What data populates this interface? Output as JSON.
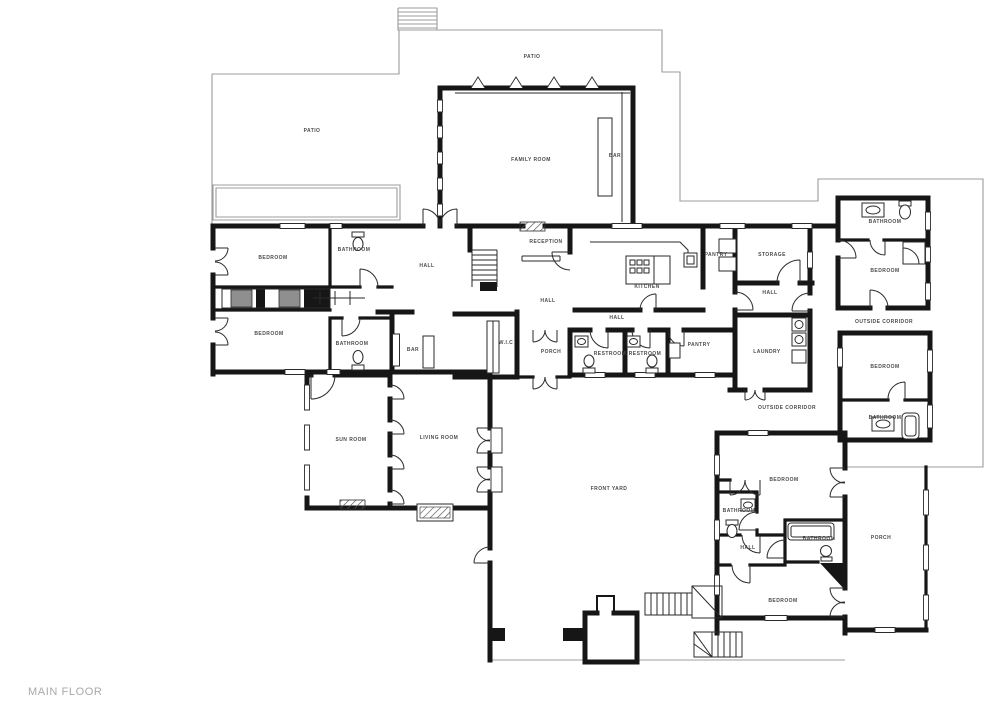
{
  "title": {
    "text": "MAIN FLOOR"
  },
  "colors": {
    "wall": "#161616",
    "thin_outline": "#9c9c9c",
    "label_text": "#4c4c4c",
    "title_text": "#a9a9a9",
    "closet_fill": "#8f8f8f",
    "background": "#ffffff"
  },
  "floor_labels": [
    {
      "id": "patio-top",
      "label": "PATIO"
    },
    {
      "id": "patio-left",
      "label": "PATIO"
    },
    {
      "id": "family-room",
      "label": "FAMILY ROOM"
    },
    {
      "id": "bar-family",
      "label": "BAR"
    },
    {
      "id": "bedroom-nw",
      "label": "BEDROOM"
    },
    {
      "id": "bathroom-nw",
      "label": "BATHROOM"
    },
    {
      "id": "hall-west",
      "label": "HALL"
    },
    {
      "id": "reception",
      "label": "RECEPTION"
    },
    {
      "id": "kitchen",
      "label": "KITCHEN"
    },
    {
      "id": "pantry-north",
      "label": "PANTRY"
    },
    {
      "id": "storage",
      "label": "STORAGE"
    },
    {
      "id": "hall-center",
      "label": "HALL"
    },
    {
      "id": "hall-east",
      "label": "HALL"
    },
    {
      "id": "bathroom-ne",
      "label": "BATHROOM"
    },
    {
      "id": "bedroom-ne",
      "label": "BEDROOM"
    },
    {
      "id": "outside-corridor-ne",
      "label": "OUTSIDE CORRIDOR"
    },
    {
      "id": "bedroom-w",
      "label": "BEDROOM"
    },
    {
      "id": "bathroom-w",
      "label": "BATHROOM"
    },
    {
      "id": "bar-small",
      "label": "BAR"
    },
    {
      "id": "wic",
      "label": "W.I.C"
    },
    {
      "id": "porch-center",
      "label": "PORCH"
    },
    {
      "id": "hall-mid",
      "label": "HALL"
    },
    {
      "id": "restroom-1",
      "label": "RESTROOM"
    },
    {
      "id": "restroom-2",
      "label": "RESTROOM"
    },
    {
      "id": "pantry-south",
      "label": "PANTRY"
    },
    {
      "id": "laundry",
      "label": "LAUNDRY"
    },
    {
      "id": "outside-corridor-e",
      "label": "OUTSIDE CORRIDOR"
    },
    {
      "id": "bedroom-e",
      "label": "BEDROOM"
    },
    {
      "id": "bathroom-e",
      "label": "BATHROOM"
    },
    {
      "id": "sun-room",
      "label": "SUN ROOM"
    },
    {
      "id": "living-room",
      "label": "LIVING ROOM"
    },
    {
      "id": "front-yard",
      "label": "FRONT YARD"
    },
    {
      "id": "bedroom-s1",
      "label": "BEDROOM"
    },
    {
      "id": "bathroom-s1",
      "label": "BATHROOM"
    },
    {
      "id": "hall-south",
      "label": "HALL"
    },
    {
      "id": "bathroom-s2",
      "label": "BATHROOM"
    },
    {
      "id": "bedroom-s2",
      "label": "BEDROOM"
    },
    {
      "id": "porch-se",
      "label": "PORCH"
    }
  ]
}
